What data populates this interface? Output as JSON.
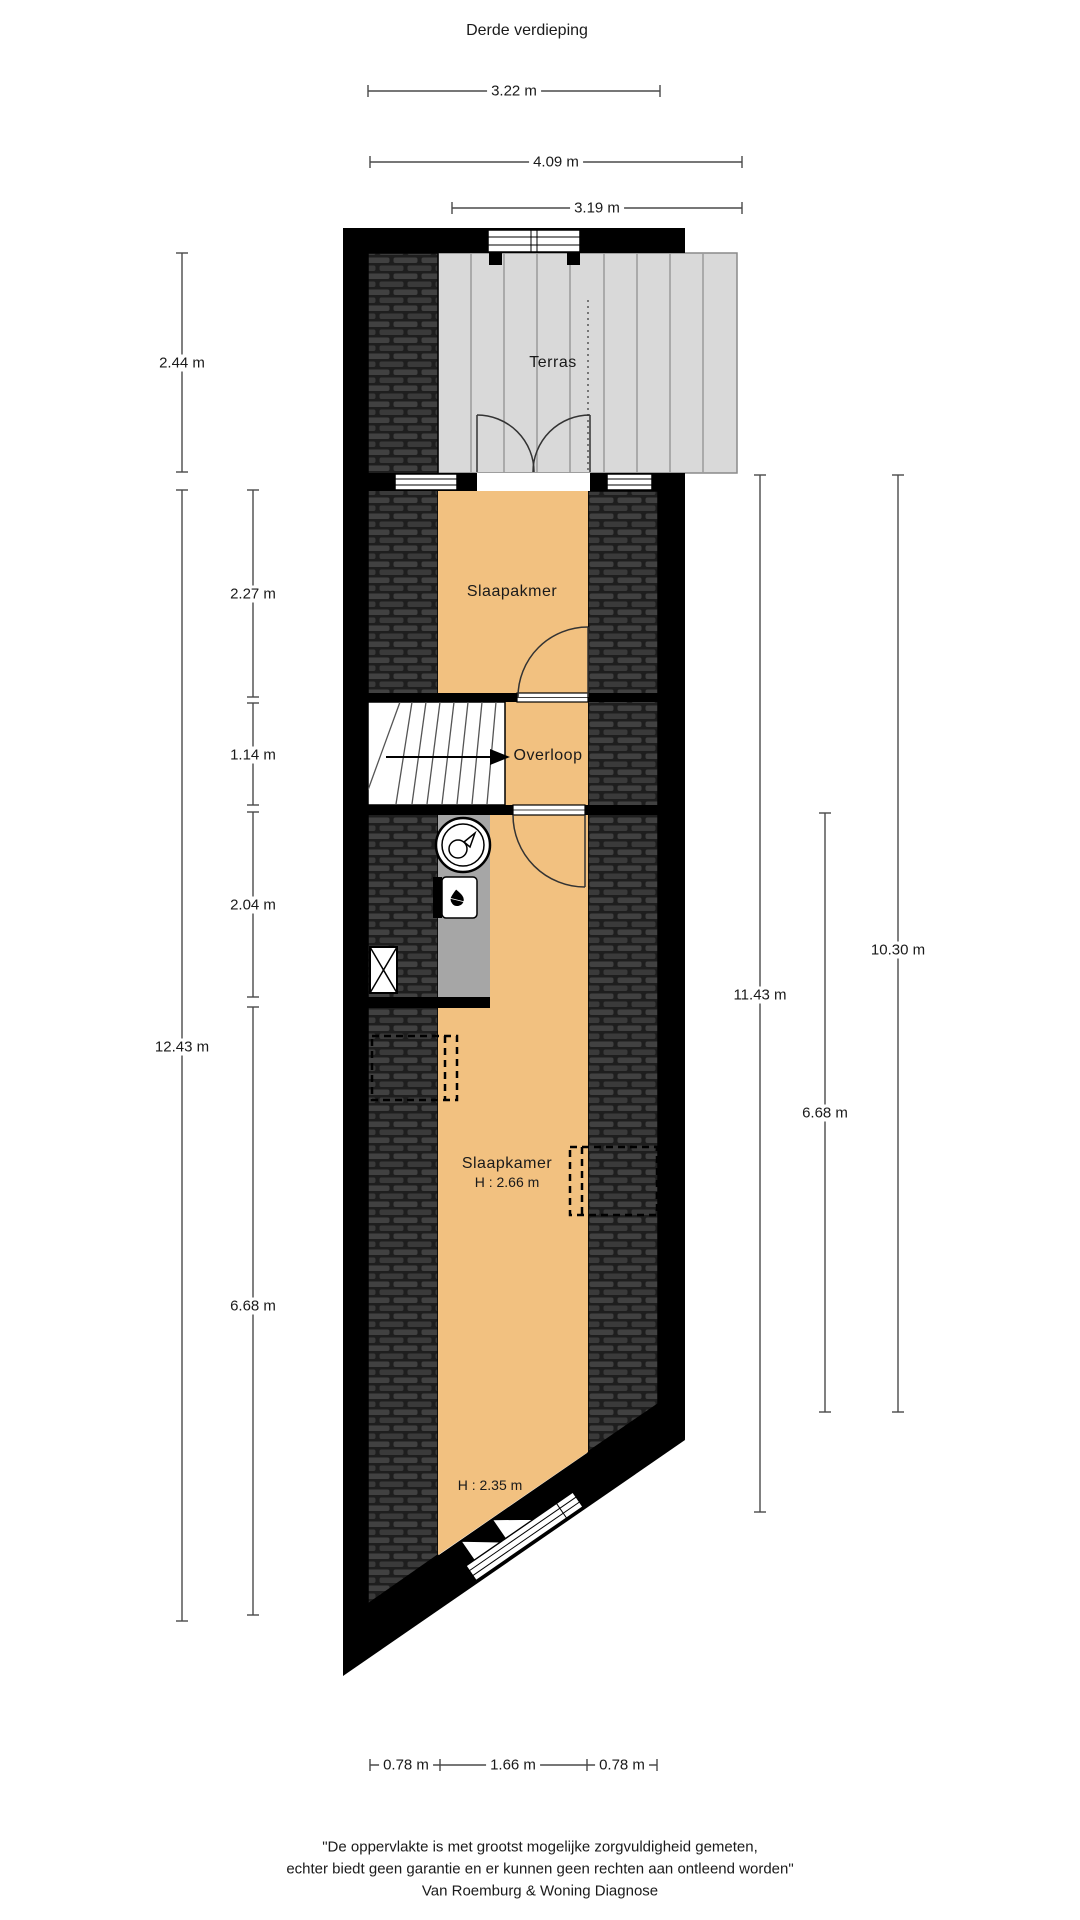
{
  "title": "Derde verdieping",
  "rooms": {
    "terras": "Terras",
    "slaapkamer_top": "Slaapakmer",
    "overloop": "Overloop",
    "slaapkamer_bottom": "Slaapkamer",
    "height_bottom_main": "H : 2.66 m",
    "height_bottom_low": "H : 2.35 m"
  },
  "dimensions": {
    "top_width_room": "3.22 m",
    "top_width_terras": "4.09 m",
    "top_width_terras_inner": "3.19 m",
    "left_terras_depth": "2.44 m",
    "left_total_depth": "12.43 m",
    "left_slaapkamer_depth": "2.27 m",
    "left_overloop_depth": "1.14 m",
    "left_closet_depth": "2.04 m",
    "left_bottom_depth": "6.68 m",
    "right_total_depth": "11.43 m",
    "right_outer_depth": "10.30 m",
    "right_bottom_depth": "6.68 m",
    "bottom_left_width": "0.78 m",
    "bottom_center_width": "1.66 m",
    "bottom_right_width": "0.78 m"
  },
  "footer": {
    "line1": "\"De oppervlakte is met grootst mogelijke zorgvuldigheid gemeten,",
    "line2": "echter biedt geen garantie en er kunnen geen rechten aan ontleend worden\"",
    "line3": "Van Roemburg & Woning Diagnose"
  },
  "colors": {
    "room_fill": "#F2C180",
    "terras_fill": "#D9D9D9",
    "closet_fill": "#A6A6A6",
    "wall": "#000000",
    "roof_base": "#1E1E1E",
    "roof_tile": "#414141",
    "dimension_line": "#4a4a4a"
  }
}
